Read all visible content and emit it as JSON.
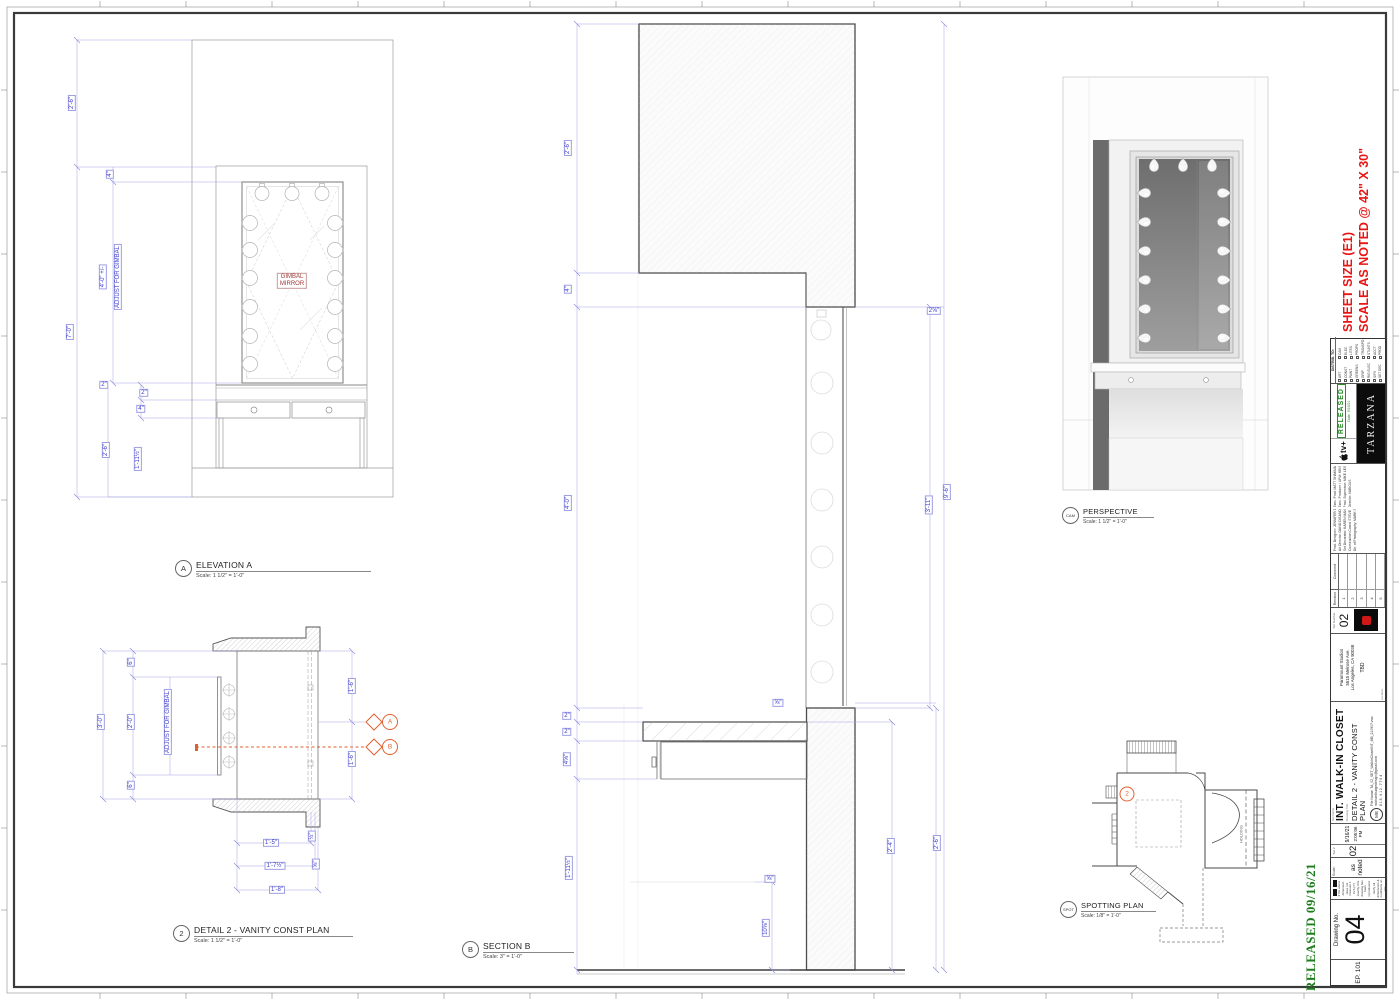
{
  "sheet": {
    "released_note": "RELEASED  09/16/21",
    "size_note_line1": "SHEET SIZE (E1)",
    "size_note_line2": "SCALE AS NOTED @ 42\" X 30\""
  },
  "elevA": {
    "callout_letter": "A",
    "title": "ELEVATION A",
    "scale": "Scale: 1 1/2\" = 1'-0\"",
    "mirror_line1": "GIMBAL",
    "mirror_line2": "MIRROR",
    "dims": [
      "2'-6\"",
      "4\"",
      "4'-0\" +/-",
      "ADJUST FOR GIMBAL",
      "7'-0\"",
      "2\"",
      "2\"",
      "4\"",
      "2'-6\"",
      "1'-11½\""
    ]
  },
  "detail2": {
    "callout_num": "2",
    "title": "DETAIL 2 - VANITY CONST PLAN",
    "scale": "Scale: 1 1/2\" = 1'-0\"",
    "marker_a": "A",
    "marker_b": "B",
    "dims": [
      "3'-0\"",
      "6\"",
      "2'-0\"",
      "ADJUST FOR GIMBAL",
      "6\"",
      "1'-6\"",
      "1'-6\"",
      "1'-5\"",
      "½\"",
      "1'-7½\"",
      "⅝\"",
      "1'-8\""
    ]
  },
  "sectionB": {
    "callout_letter": "B",
    "title": "SECTION B",
    "scale": "Scale: 3\" = 1'-0\"",
    "dims": [
      "2'-6\"",
      "4\"",
      "4'-0\"",
      "2⅝\"",
      "3'-11\"",
      "9'-6\"",
      "2\"",
      "2\"",
      "4⅝\"",
      "1'-11½\"",
      "⅝\"",
      "⅝\"",
      "10⅝\"",
      "2'-4\"",
      "2'-6\""
    ]
  },
  "perspective": {
    "callout_letter": "CAM",
    "title": "PERSPECTIVE",
    "scale": "Scale: 1 1/2\" = 1'-0\""
  },
  "spotting": {
    "callout_letter": "SPOT",
    "title": "SPOTTING PLAN",
    "scale": "Scale: 1/8\" = 1'-0\"",
    "marker": "2",
    "room_label": "HOLDING"
  },
  "titleblock": {
    "episode": "EP. 101",
    "drawing_no_label": "Drawing No.",
    "drawing_no": "04",
    "disclaimer_lines": [
      "If the above dimension does not measure 1 inch (1\") exactly, this drawing has been reproduced.",
      "Verify all dimensions & conditions on site."
    ],
    "scale_label": "Scale:",
    "scale_value": "as noted",
    "set_no_label": "Set #",
    "set_no": "02",
    "date": "9/16/21",
    "time": "2:05:06 PM",
    "set_name_label": "Set Name",
    "set_name": "INT. WALK-IN CLOSET",
    "drawing_title_label": "Drawing Title",
    "drawing_title": "DETAIL 2  -  VANITY CONST PLAN",
    "file_name": "File Name:  TA_02_SET_WalkInClosetINT_MB_210907.vwx",
    "email": "michaelbudgedesign@gmail.com",
    "phone": "8 1 8 . 6 1 2 . 7 7 6 4",
    "logo_monogram": "MB",
    "location_label": "Location",
    "address_lines": [
      "Paramount Studios",
      "5515 Melrose Ave.",
      "Los Angeles, CA 90038"
    ],
    "stage": "TBD",
    "set_number_label": "Set Number",
    "set_number": "02",
    "revision_header": [
      "Revision",
      "Comment"
    ],
    "revision_rows": [
      "1",
      "2",
      "3",
      "4",
      "5"
    ],
    "credits_col1": [
      "Prod. Designer:  JENNIFER DEHGHAN",
      "Art Director:  DAVID DISANDRO",
      "Set Decorator:  KAREN MANTHEY",
      "Construction Coord:  STEVE HOWARD",
      "Dir. of Photography:  MARK SCHWARTZBARD"
    ],
    "credits_col2": [
      "Exec. Prod:  MATT SHAKMAN · ALAN YANG · LIZ SARNOFF",
      "Exec. Producer / UPM:  KRIS EBER",
      "Prod. Supervisor:  MIKE LESNIK",
      "Director:  VARIOUS"
    ],
    "network": "tv+",
    "released_stamp": "RELEASED",
    "released_date": "Date: 9/16/21",
    "show": "TARZANA",
    "distrib_header": "DISTRIB. TO:",
    "distrib_col1": [
      "ART",
      "CONST",
      "PAINT",
      "GREENS",
      "GRIP",
      "RIG ELEC",
      "S/FX",
      "SET DEC"
    ],
    "distrib_col2": [
      "CAM",
      "ELEC",
      "LITES",
      "PROPS",
      "TRANSPO",
      "STUNTS",
      "ACCT",
      "PROD"
    ]
  }
}
